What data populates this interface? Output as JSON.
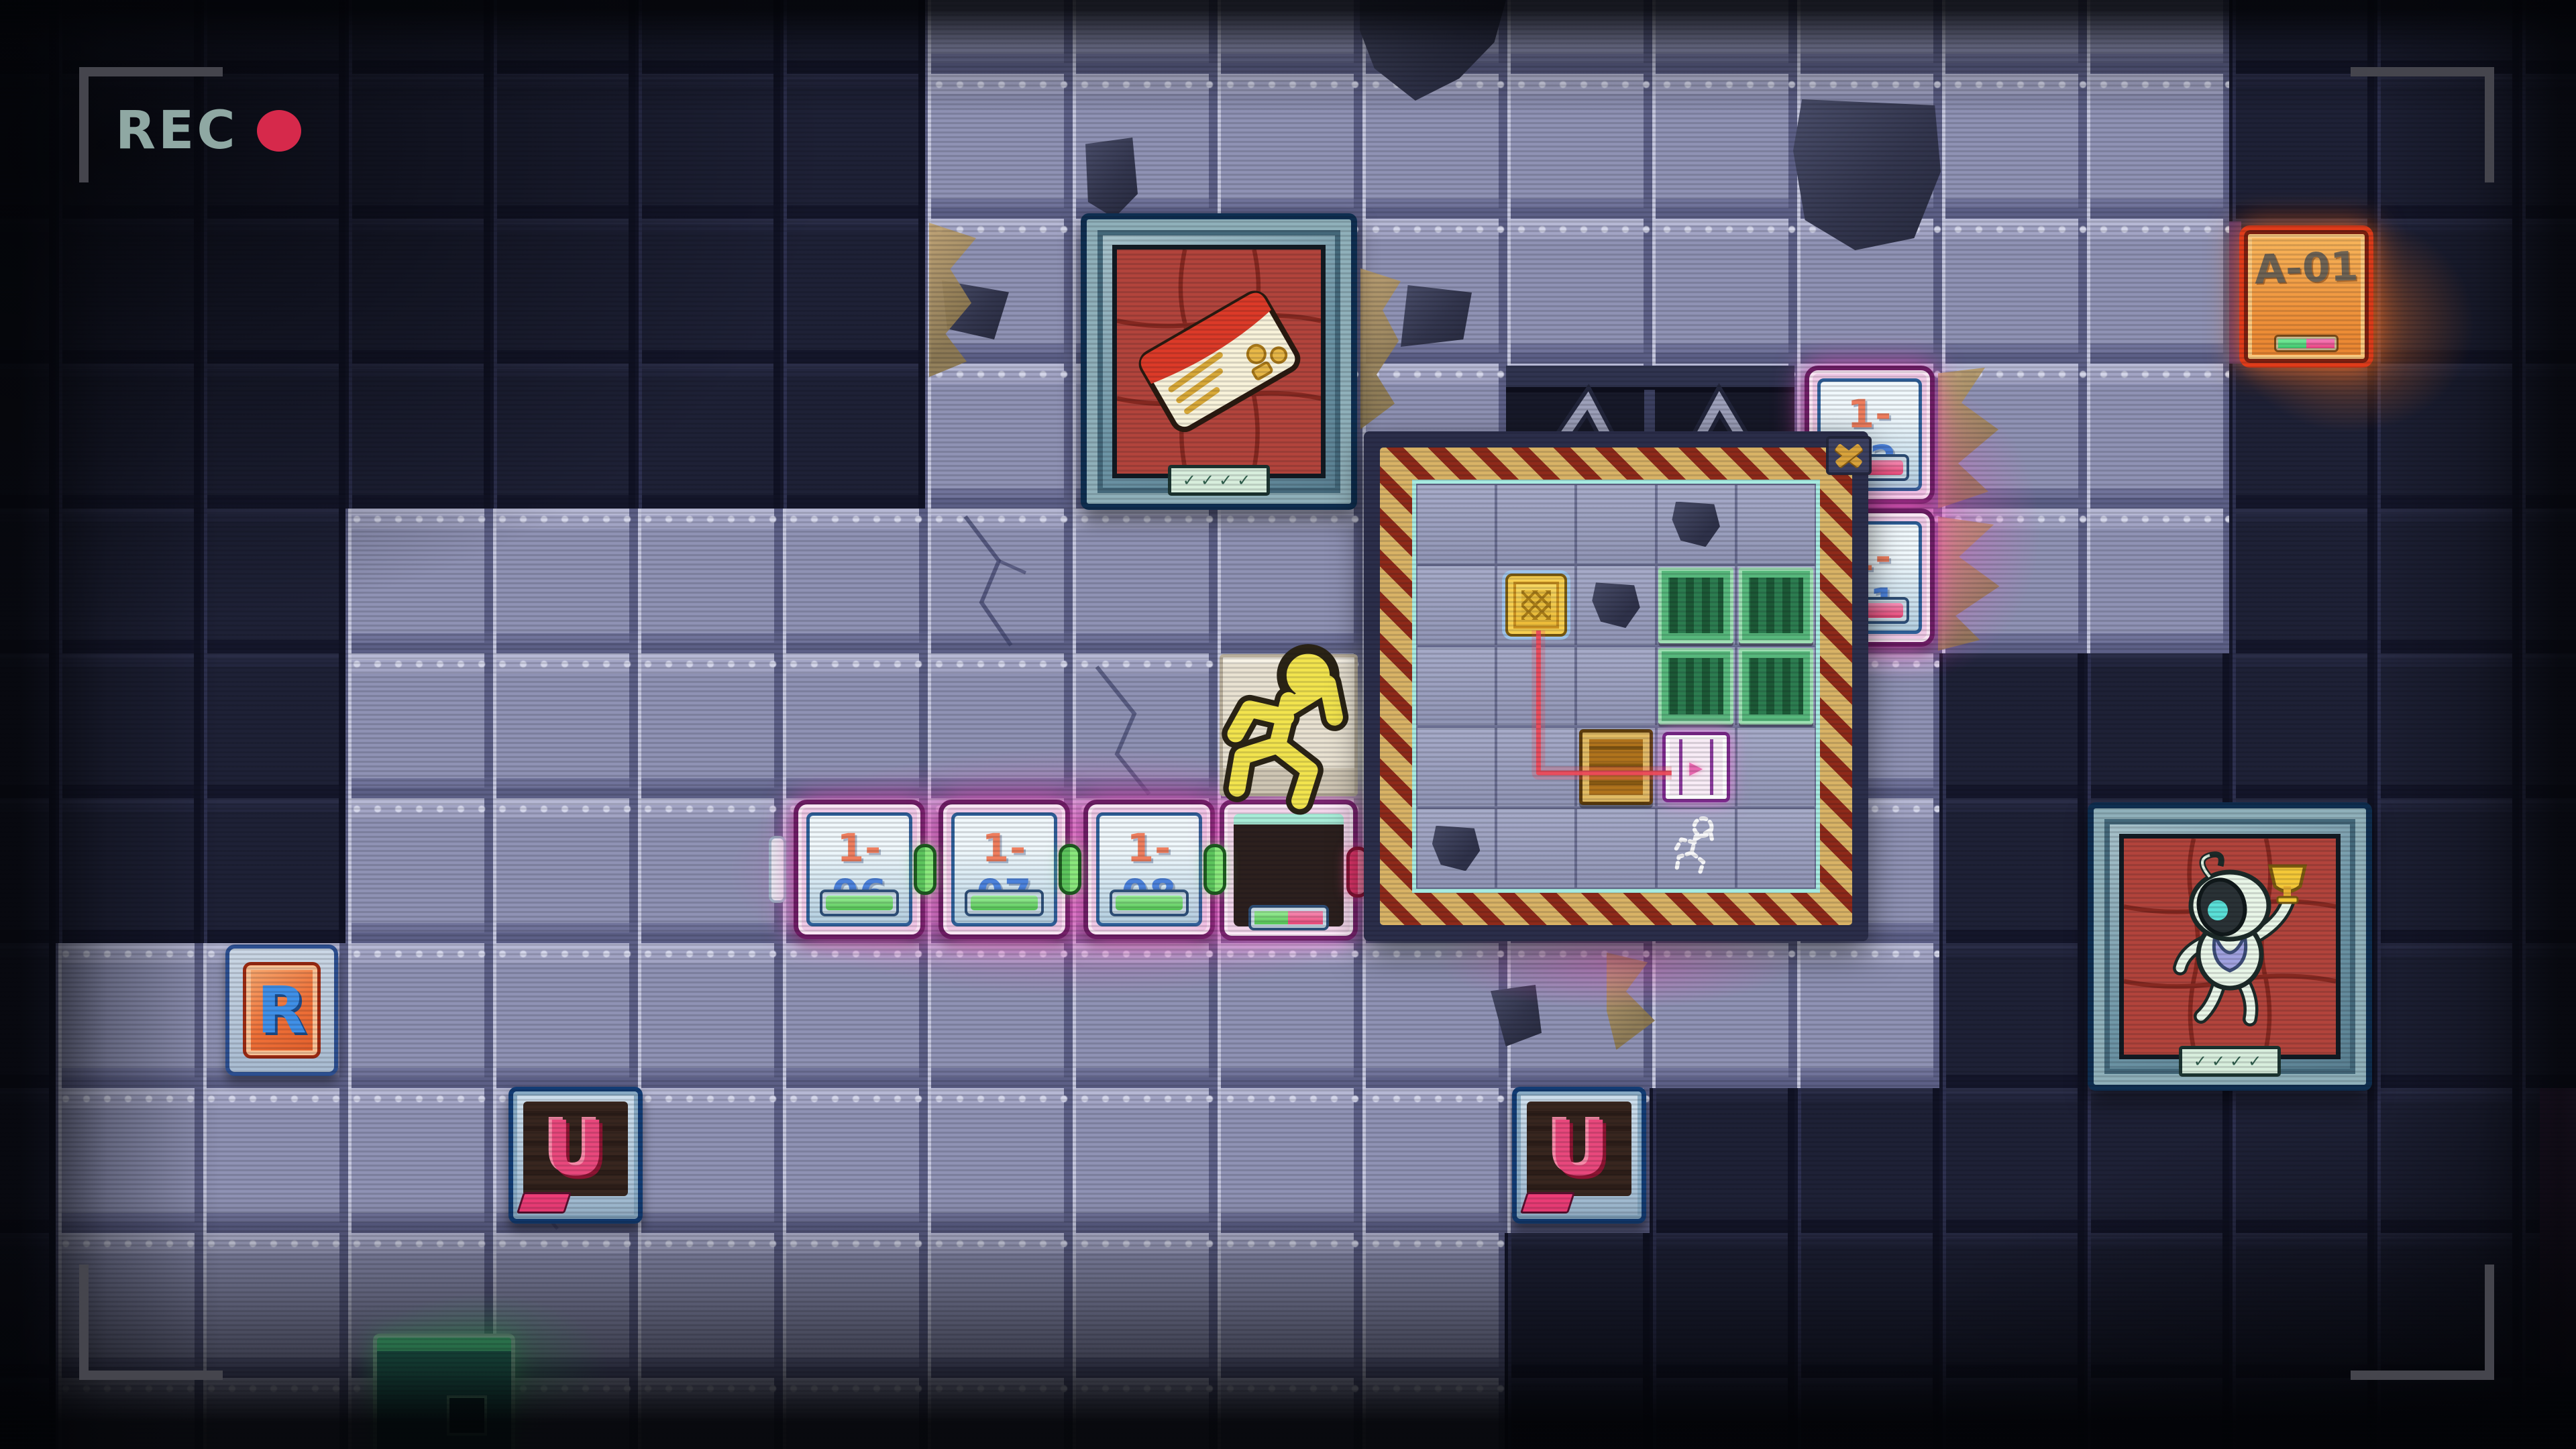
{
  "hud": {
    "rec_label": "REC",
    "rec_text_color": "#8FA8A3",
    "rec_dot_color": "#D6294B",
    "bracket_color": "#45454D"
  },
  "world": {
    "colors": {
      "tile_lavender": "#9093B6",
      "tile_navy": "#20233A",
      "glow_pink": "#FF55CC",
      "glow_orange": "#FF7A28",
      "glow_green": "#49E87A",
      "chip_number_blue": "#4C82DC",
      "chip_prefix_salmon": "#EF7E5E"
    },
    "area_badge": {
      "label": "A-01"
    },
    "restart_tile": {
      "label": "R"
    },
    "undo_tile_left": {
      "label": "U"
    },
    "undo_tile_right": {
      "label": "U"
    },
    "chips": [
      {
        "prefix": "1-",
        "number": "06",
        "indicator": "green"
      },
      {
        "prefix": "1-",
        "number": "07",
        "indicator": "green"
      },
      {
        "prefix": "1-",
        "number": "08",
        "indicator": "green"
      },
      {
        "prefix": "1-",
        "number": "12",
        "indicator": "pink"
      },
      {
        "prefix": "1-",
        "number": "11",
        "indicator": "pink"
      }
    ],
    "displays": {
      "keycard_plaque": "✓✓✓✓",
      "trophy_plaque": "✓✓✓✓"
    }
  },
  "popup": {
    "close_label": "X",
    "grid_size": 5,
    "grid": [
      "",
      "",
      "",
      "debris",
      "",
      "",
      "gold",
      "debris",
      "green",
      "green",
      "",
      "",
      "",
      "green",
      "green",
      "",
      "",
      "wood",
      "exit",
      "",
      "debris",
      "",
      "",
      "ghost",
      ""
    ],
    "exit_arrow": "▸",
    "wire": {
      "from_cell": [
        2,
        2
      ],
      "to_cell": [
        4,
        4
      ],
      "color": "#EC4A5A"
    }
  }
}
